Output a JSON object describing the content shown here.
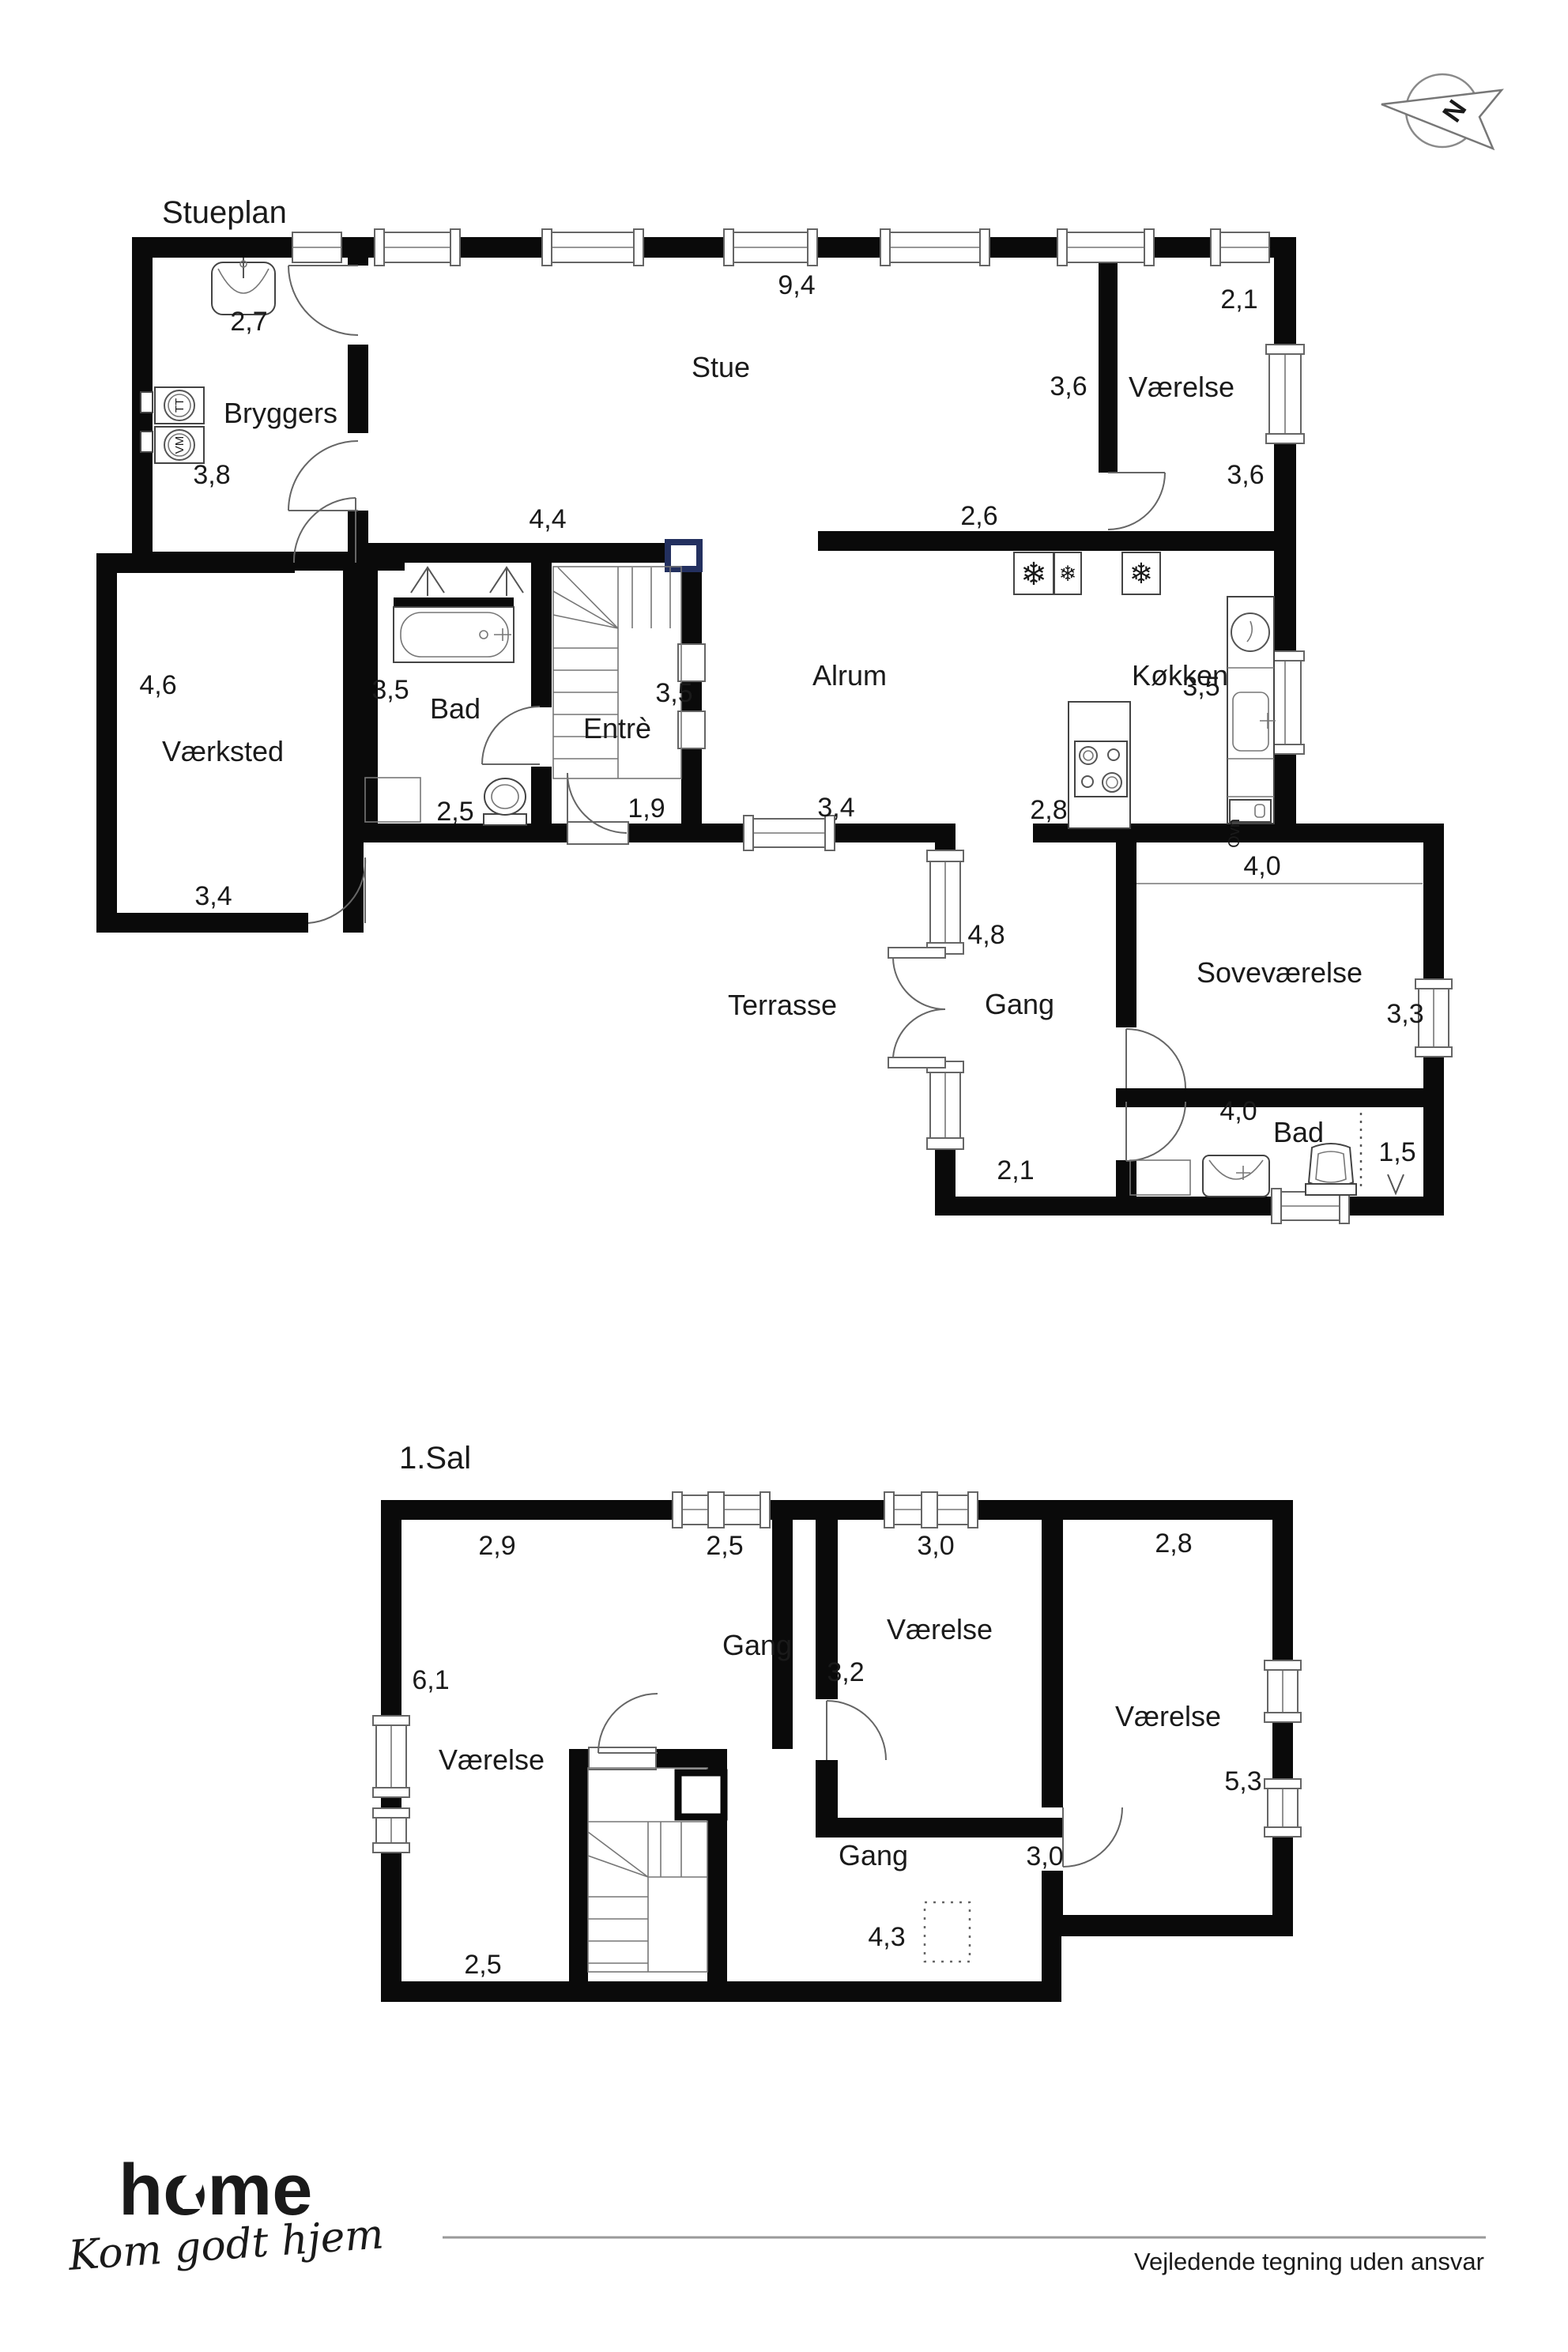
{
  "ground_floor": {
    "title": "Stueplan",
    "rooms": {
      "bryggers": "Bryggers",
      "stue": "Stue",
      "vaerelse1": "Værelse",
      "vaerksted": "Værksted",
      "bad": "Bad",
      "entre": "Entrè",
      "alrum": "Alrum",
      "koekken": "Køkken",
      "terrasse": "Terrasse",
      "gang": "Gang",
      "sovevaerelse": "Soveværelse",
      "bad2": "Bad"
    },
    "measurements": {
      "bryggers_top": "2,7",
      "bryggers_left": "3,8",
      "stue_top": "9,4",
      "vaerelse1_top": "2,1",
      "vaerelse1_left": "3,6",
      "vaerelse1_right": "3,6",
      "wall_44": "4,4",
      "koekken_gap": "2,6",
      "vaerksted_left": "4,6",
      "vaerksted_bottom": "3,4",
      "bad_left": "3,5",
      "bad_bottom": "2,5",
      "entre_right": "3,5",
      "entre_bottom": "1,9",
      "alrum_bottom": "3,4",
      "koekken_right": "3,5",
      "koekken_bottom": "2,8",
      "gang_right": "4,8",
      "gang_bottom": "2,1",
      "sove_top": "4,0",
      "sove_right": "3,3",
      "bad2_top": "4,0",
      "bad2_right": "1,5"
    },
    "appliances": {
      "dryer": "TT",
      "washer": "VM",
      "oven": "Ovn"
    }
  },
  "first_floor": {
    "title": "1.Sal",
    "rooms": {
      "vaerelse1": "Værelse",
      "gang1": "Gang",
      "vaerelse2": "Værelse",
      "vaerelse3": "Værelse",
      "gang2": "Gang"
    },
    "measurements": {
      "v1_top": "2,9",
      "gang1_top": "2,5",
      "v2_top": "3,0",
      "v3_top": "2,8",
      "v1_left": "6,1",
      "v2_left": "3,2",
      "v3_right": "5,3",
      "gang2_right": "3,0",
      "gang2_bottom": "4,3",
      "v1_bottom": "2,5"
    }
  },
  "compass": {
    "north": "N"
  },
  "footer": {
    "brand": "home",
    "tagline": "Kom godt hjem",
    "disclaimer": "Vejledende tegning uden ansvar",
    "brand_color": "#e2001a"
  }
}
